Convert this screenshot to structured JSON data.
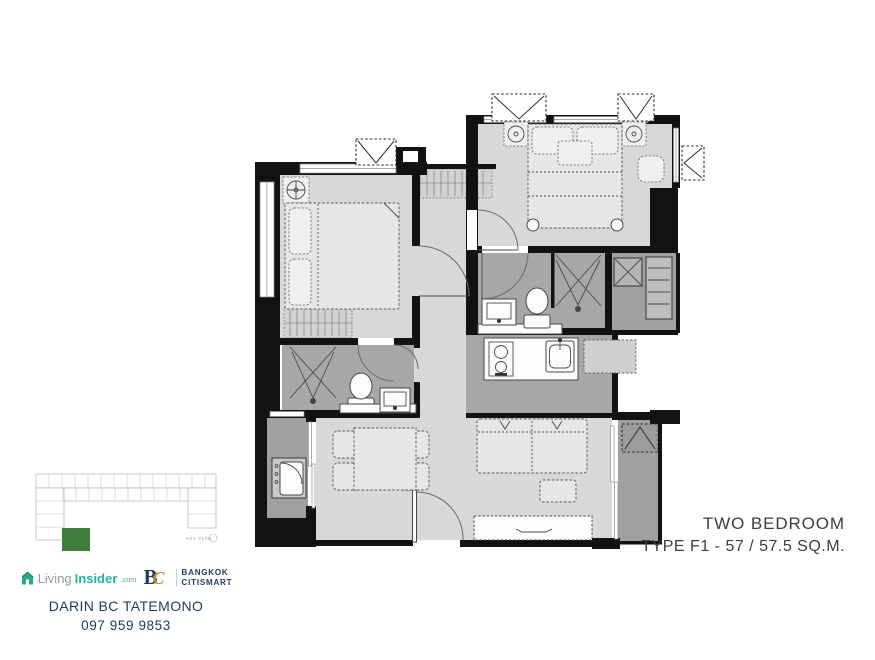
{
  "colors": {
    "wall": "#121212",
    "floor_light": "#d8d8d8",
    "floor_mid": "#a7a7a7",
    "floor_balcony": "#a0a0a0",
    "label_text": "#3d3d3d",
    "navy": "#1e3a5f",
    "teal": "#26b3a4",
    "gold": "#c08a2d",
    "logo_gray": "#979797",
    "key_green": "#3e7d3a"
  },
  "floor_plan": {
    "label_line1": "TWO BEDROOM",
    "label_line2": "TYPE F1 - 57 / 57.5 SQ.M.",
    "key_plan_label": "KEY PLAN"
  },
  "branding": {
    "living_insider": {
      "prefix": "Living",
      "suffix": "Insider",
      "tld": ".com"
    },
    "bc_logo": {
      "b": "B",
      "c": "C",
      "line1": "BANGKOK",
      "line2": "CITISMART"
    }
  },
  "agent": {
    "name": "DARIN BC TATEMONO",
    "phone": "097 959 9853"
  }
}
